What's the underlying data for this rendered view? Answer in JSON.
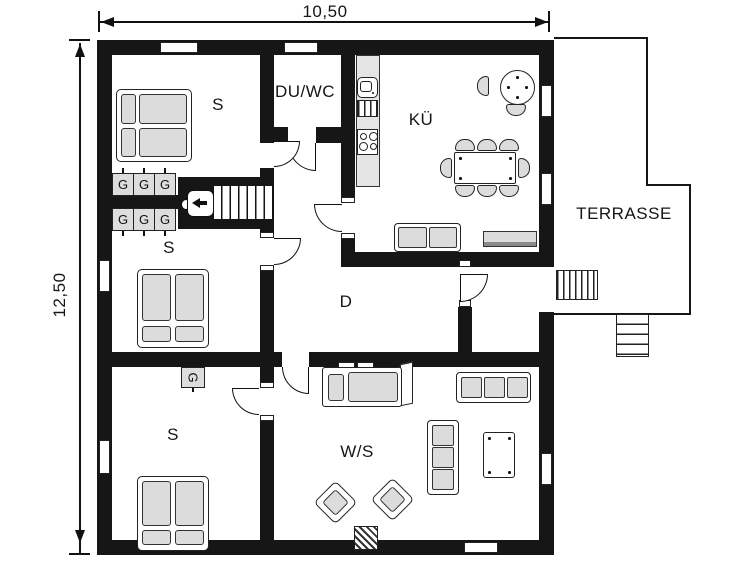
{
  "plan": {
    "dimension_width": "10,50",
    "dimension_height": "12,50"
  },
  "rooms": {
    "bedroom_top": {
      "label": "S"
    },
    "shower_wc": {
      "label": "DU/WC"
    },
    "kitchen": {
      "label": "KÜ"
    },
    "terrace": {
      "label": "TERRASSE"
    },
    "bedroom_middle": {
      "label": "S"
    },
    "hallway": {
      "label": "D"
    },
    "bedroom_bottom": {
      "label": "S"
    },
    "living_sleeping": {
      "label": "W/S"
    }
  },
  "furniture": {
    "wardrobe_label": "G"
  },
  "colors": {
    "wall": "#161616",
    "furniture_fill": "#dcdcdc",
    "counter_fill": "#e4e4e4",
    "outline": "#111111"
  }
}
